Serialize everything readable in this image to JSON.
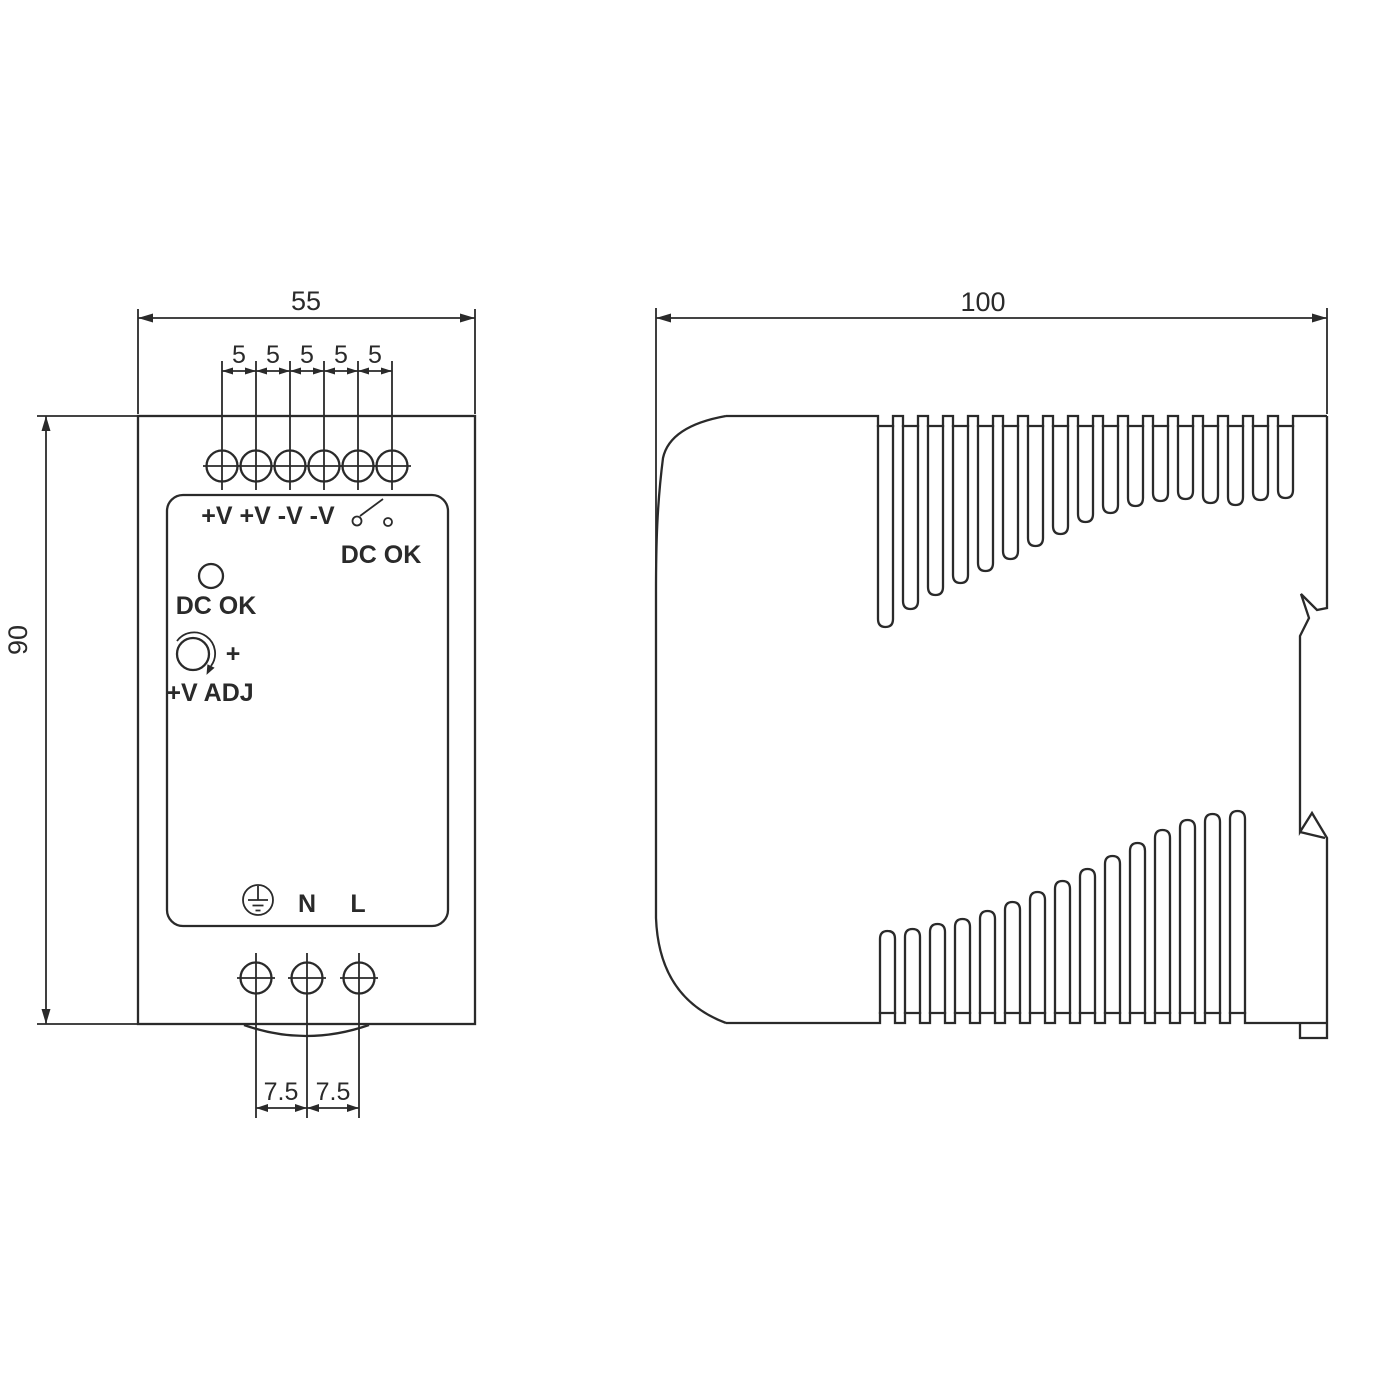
{
  "front_view": {
    "width_dim": "55",
    "pitch_dims": [
      "5",
      "5",
      "5",
      "5",
      "5"
    ],
    "height_dim": "90",
    "bottom_pitch_dims": [
      "7.5",
      "7.5"
    ],
    "panel": {
      "output_terminals": "+V +V -V -V",
      "relay_label": "DC OK",
      "led_label": "DC OK",
      "adj_plus": "+",
      "adj_label": "+V ADJ",
      "neutral": "N",
      "line": "L"
    }
  },
  "side_view": {
    "depth_dim": "100"
  },
  "style": {
    "line_color": "#2a2a2a",
    "background": "#ffffff"
  }
}
